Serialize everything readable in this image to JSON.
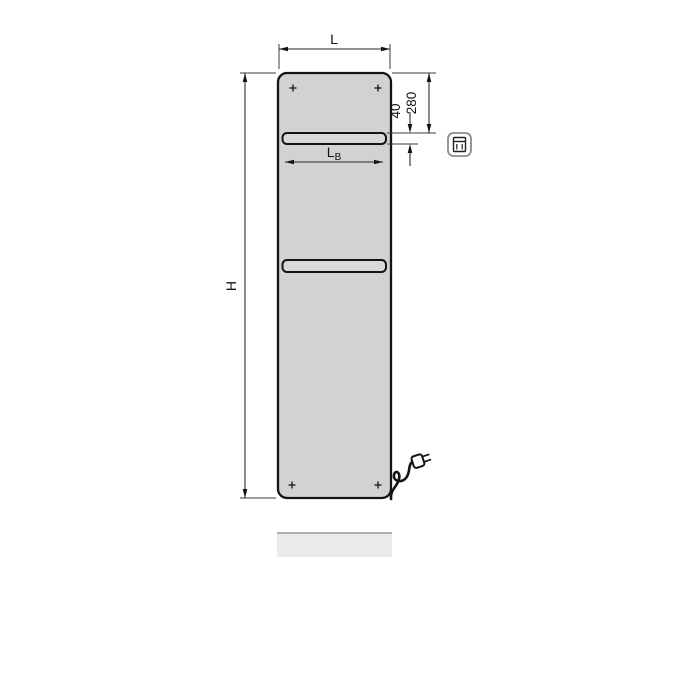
{
  "page": {
    "background": "#ffffff",
    "description": "Technical dimensional drawing of a flat electric panel radiator with two towel bars, power cord with plug, and dimension annotations"
  },
  "diagram": {
    "labels": {
      "width_label": "L",
      "height_label": "H",
      "bar_width_main": "L",
      "bar_width_sub": "B",
      "top_offset_label": "280",
      "bar_thickness_label": "40"
    },
    "colors": {
      "outline": "#141414",
      "dimension_line": "#2a2a2a",
      "extension_line": "#3c3c3c",
      "panel_fill": "#d2d2d2",
      "bar_fill": "#d9d9d9",
      "shadow_fill": "#eaeaea",
      "shadow_edge": "#969696",
      "icon_border": "#8c8c8c"
    },
    "icons": {
      "control_unit": "electric-control-unit-icon",
      "plug": "power-plug-icon"
    }
  }
}
